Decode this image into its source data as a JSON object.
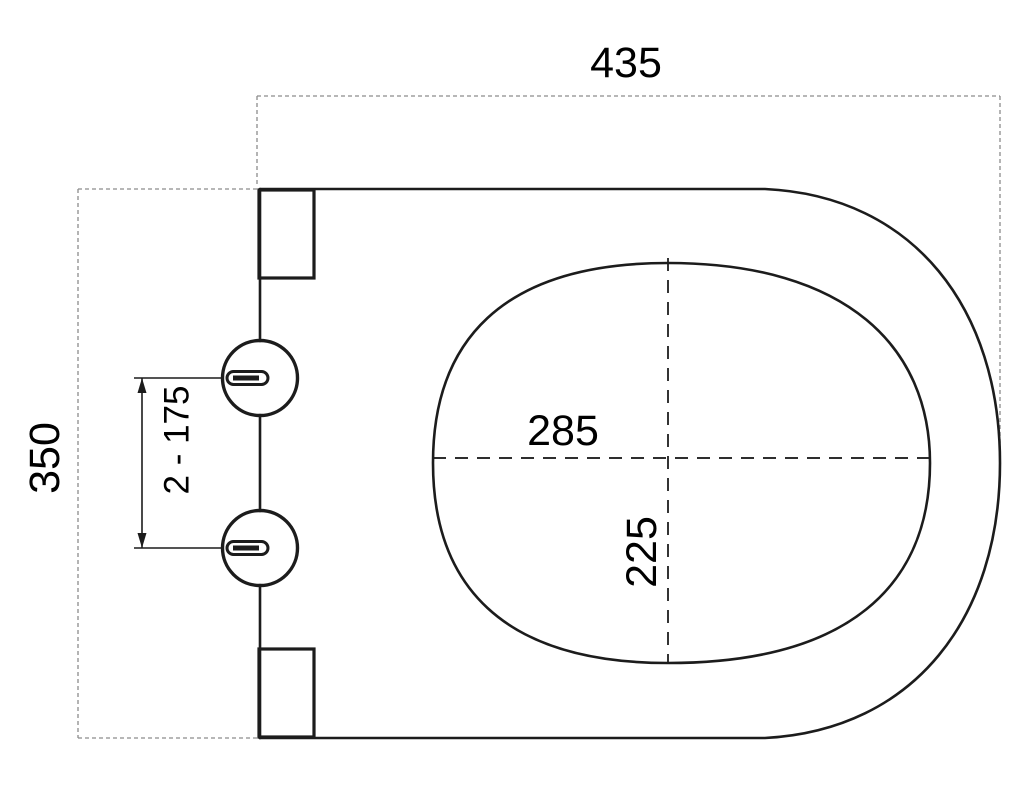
{
  "drawing": {
    "title": "Toilet seat top-view dimension drawing",
    "labels": {
      "overall_width": "435",
      "overall_depth": "350",
      "hinge_spacing": "2 - 175",
      "inner_width": "285",
      "inner_length": "225"
    },
    "colors": {
      "background": "#ffffff",
      "outline": "#1c1c1c",
      "centerline": "#111111",
      "extent_dash": "#8c8c8c",
      "text": "#000000"
    }
  }
}
